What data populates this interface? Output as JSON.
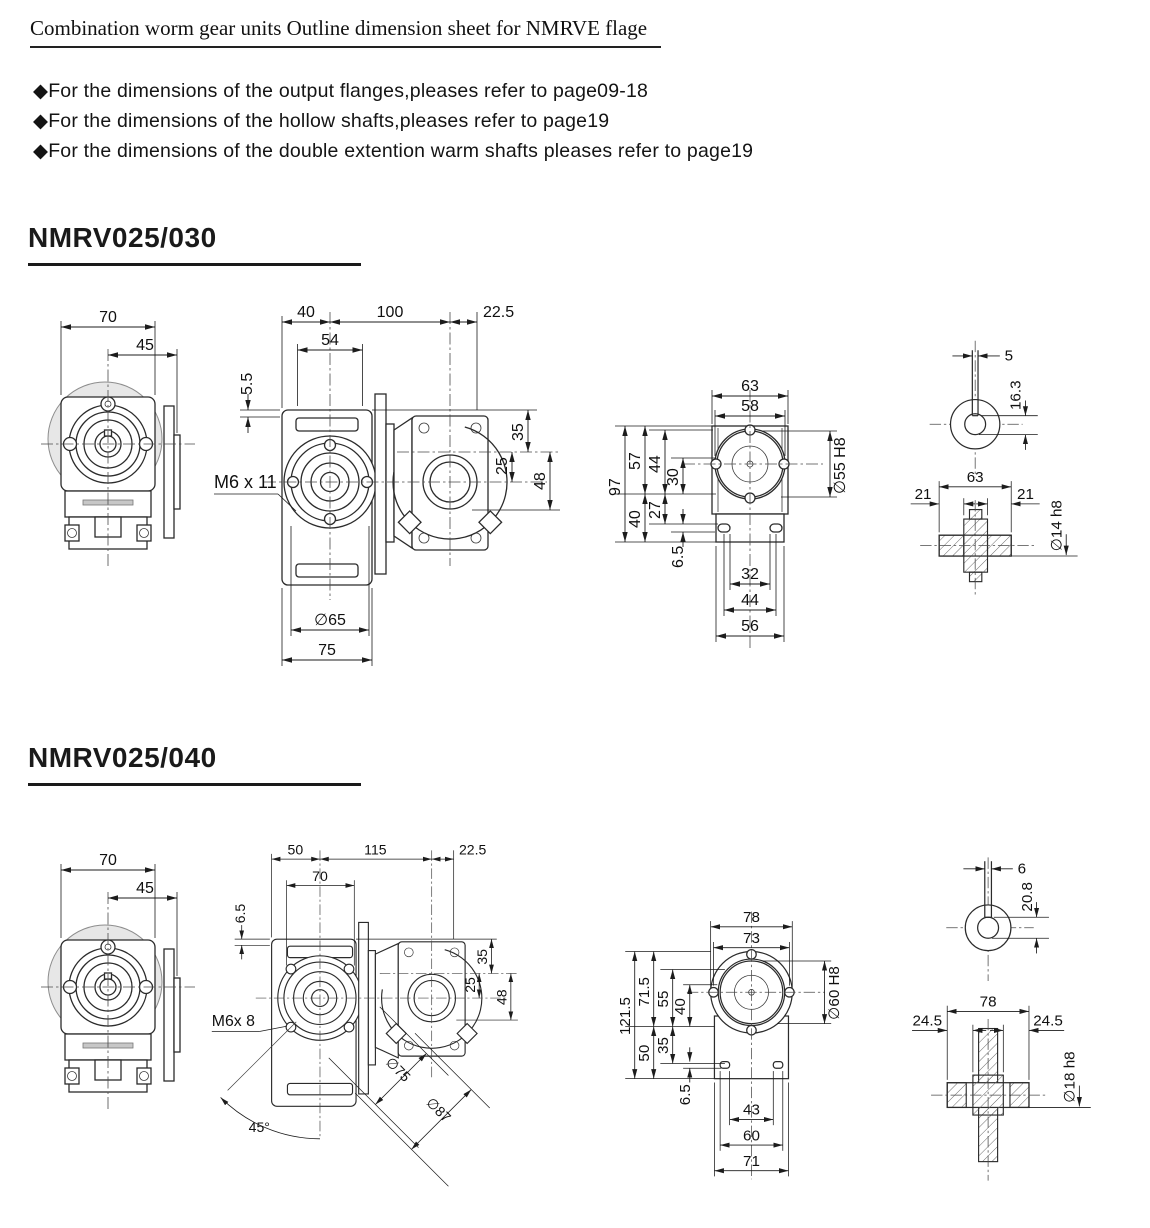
{
  "header": {
    "title": "Combination worm gear units Outline dimension sheet for NMRVE flage",
    "notes": [
      "◆For the dimensions of the output flanges,pleases refer to page09-18",
      "◆For the dimensions of the hollow shafts,pleases refer to page19",
      "◆For the dimensions of the double extention warm shafts pleases refer to page19"
    ]
  },
  "s1": {
    "heading": "NMRV025/030",
    "front": {
      "overall_width": "70",
      "center_to_flange": "45"
    },
    "side": {
      "edge_to_center": "40",
      "center_to_motor": "100",
      "shaft_overhang": "22.5",
      "bolt_span": "54",
      "top_lip": "5.5",
      "tap_label": "M6 x 11",
      "top_to_worm_axis": "35",
      "center_distance": "25",
      "worm_axis_to_base": "48",
      "flange_dia": "∅65",
      "body_width": "75"
    },
    "rear": {
      "flange_width": "63",
      "bolt_width": "58",
      "total_height": "97",
      "upper_height": "57",
      "bolt_to_axis": "44",
      "axis_to_near": "30",
      "lower_height": "40",
      "axis_to_foot": "27",
      "foot_slot": "6.5",
      "bore": "∅55 H8",
      "slot_inner_span": "32",
      "slot_center_span": "44",
      "body_width": "56"
    },
    "shaft": {
      "key_width": "5",
      "key_depth": "16.3",
      "length": "63",
      "ext_left": "21",
      "ext_right": "21",
      "diameter": "∅14 h8"
    }
  },
  "s2": {
    "heading": "NMRV025/040",
    "front": {
      "overall_width": "70",
      "center_to_flange": "45"
    },
    "side": {
      "edge_to_center": "50",
      "center_to_motor": "115",
      "shaft_overhang": "22.5",
      "bolt_span": "70",
      "top_lip": "6.5",
      "tap_label": "M6x 8",
      "top_to_worm_axis": "35",
      "center_distance": "25",
      "worm_axis_to_base": "48",
      "flange_dia": "∅75",
      "flange_outer_dia": "∅87",
      "flange_angle": "45°"
    },
    "rear": {
      "flange_width": "78",
      "bolt_width": "73",
      "total_height": "121.5",
      "upper_height": "71.5",
      "bolt_to_axis": "55",
      "axis_to_near": "40",
      "lower_height": "50",
      "axis_to_foot": "35",
      "foot_slot": "6.5",
      "bore": "∅60 H8",
      "slot_inner_span": "43",
      "slot_center_span": "60",
      "body_width": "71"
    },
    "shaft": {
      "key_width": "6",
      "key_depth": "20.8",
      "length": "78",
      "ext_left": "24.5",
      "ext_right": "24.5",
      "diameter": "∅18 h8"
    }
  }
}
